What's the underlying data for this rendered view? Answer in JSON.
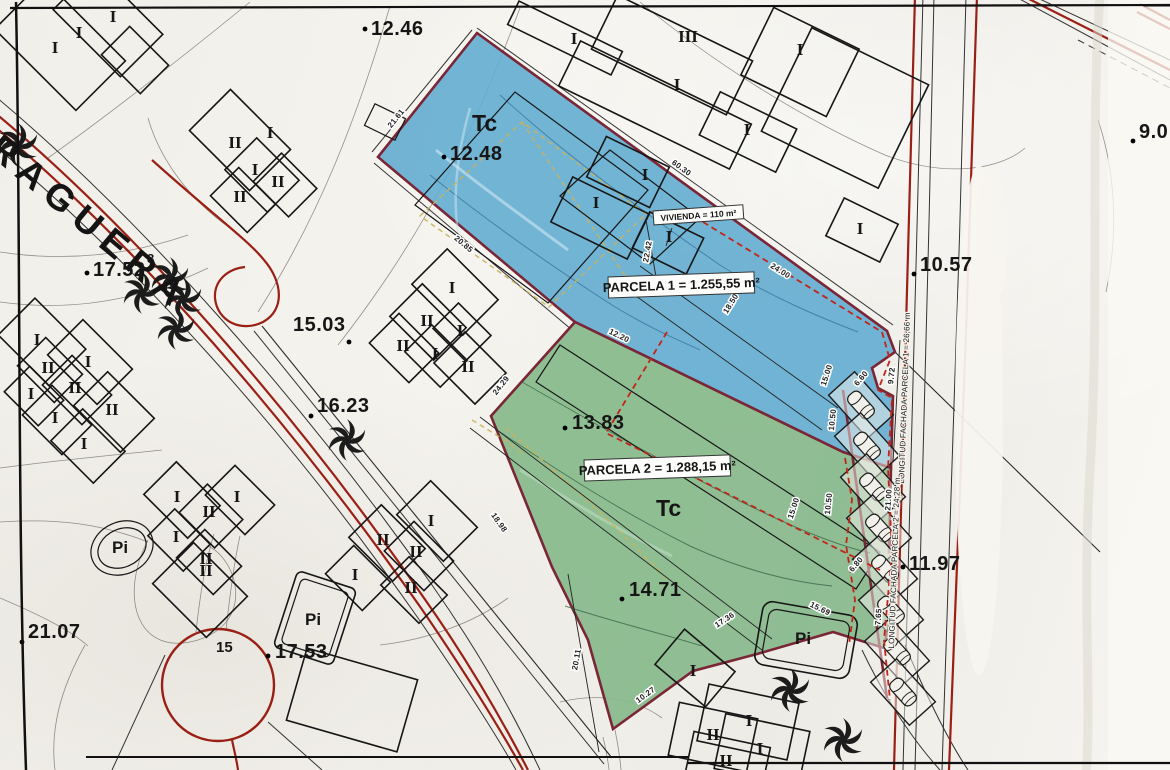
{
  "map": {
    "street_name": "RAGUERA",
    "land_use": "Tc",
    "pool": "Pi",
    "road_number": "15",
    "roman": {
      "i": "I",
      "ii": "II",
      "iii": "III"
    },
    "parcel1": {
      "area_label": "PARCELA 1 = 1.255,55 m²",
      "frontage_label": "LONGITUD FACHADA PARCELA 1 = 26,66 m",
      "fill": "#66aed1"
    },
    "parcel2": {
      "area_label": "PARCELA 2 = 1.288,15 m²",
      "frontage_label": "LONGITUD FACHADA PARCELA 2 = 24,28 m",
      "fill": "#8abb8e"
    },
    "vivienda_label": "VIVIENDA = 110 m²",
    "elevations": {
      "e1246": "12.46",
      "e1248": "12.48",
      "e1752": "17.52",
      "e1752_sup": "8",
      "e1503": "15.03",
      "e1623": "16.23",
      "e2107": "21.07",
      "e1753": "17.53",
      "e1383": "13.83",
      "e1471": "14.71",
      "e1057": "10.57",
      "e1197": "11.97",
      "e90": "9.0"
    },
    "measurements": {
      "m2161": "21.61",
      "m6030": "60.30",
      "m2085": "20.85",
      "m2242": "22.42",
      "m2400": "24.00",
      "m1850": "18.50",
      "m1220": "12.20",
      "m2429": "24.29",
      "m1898": "18.98",
      "m2011": "20.11",
      "m1027": "10.27",
      "m1736": "17.36",
      "m1569": "15.69",
      "m765": "7.65",
      "m2100": "21.00",
      "m972": "9.72",
      "m660": "6.60",
      "m680": "6.80",
      "m1050": "10.50",
      "m1500": "15.00"
    },
    "colors": {
      "road_red": "#9a2015",
      "parcel_boundary": "#7a2636",
      "dashed_red": "#c22418",
      "ochre_dash": "#c9b35a"
    }
  }
}
